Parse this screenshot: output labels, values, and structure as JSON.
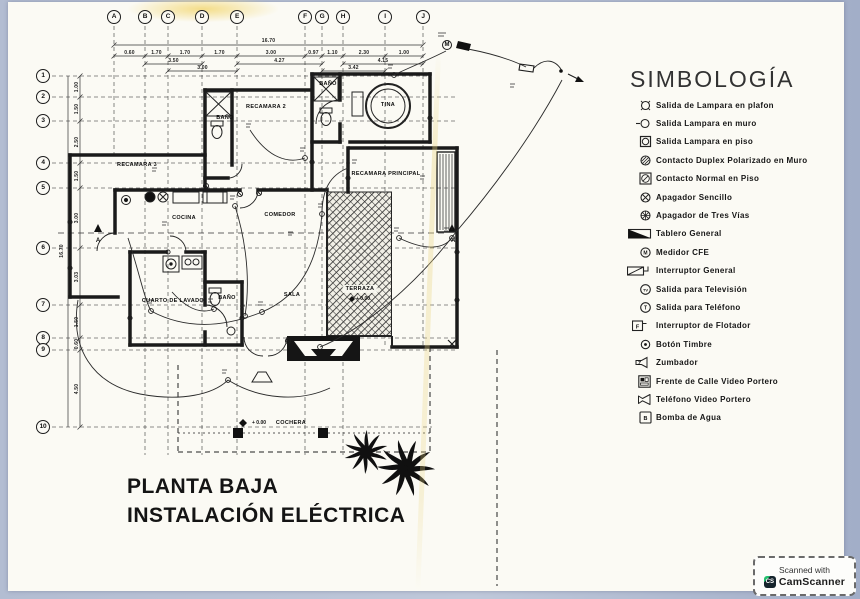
{
  "colors": {
    "paper": "#fbfaf4",
    "border_blue": "#b3bdd2",
    "ink": "#1a1a1a",
    "badge_green": "#23c06e"
  },
  "grid": {
    "columns": [
      {
        "label": "A",
        "x": 114,
        "y2": 155
      },
      {
        "label": "B",
        "x": 145,
        "y2": 455
      },
      {
        "label": "C",
        "x": 168,
        "y2": 455
      },
      {
        "label": "D",
        "x": 202,
        "y2": 455
      },
      {
        "label": "E",
        "x": 237,
        "y2": 455
      },
      {
        "label": "F",
        "x": 305,
        "y2": 455
      },
      {
        "label": "G",
        "x": 322,
        "y2": 345
      },
      {
        "label": "H",
        "x": 343,
        "y2": 455
      },
      {
        "label": "I",
        "x": 385,
        "y2": 345
      },
      {
        "label": "J",
        "x": 423,
        "y2": 347
      }
    ],
    "rows": [
      {
        "label": "1",
        "y": 76,
        "x2": 430
      },
      {
        "label": "2",
        "y": 97,
        "x2": 458
      },
      {
        "label": "3",
        "y": 121,
        "x2": 458
      },
      {
        "label": "4",
        "y": 163,
        "x2": 350
      },
      {
        "label": "5",
        "y": 188,
        "x2": 458
      },
      {
        "label": "6",
        "y": 248,
        "x2": 458
      },
      {
        "label": "7",
        "y": 305,
        "x2": 458
      },
      {
        "label": "8",
        "y": 338,
        "x2": 458
      },
      {
        "label": "9",
        "y": 350,
        "x2": 458
      },
      {
        "label": "10",
        "y": 427,
        "x2": 432
      }
    ],
    "top_total": "16.70",
    "top_segments": [
      "0.60",
      "1.70",
      "1.70",
      "1.70",
      "3.00",
      "0.97",
      "1.10",
      "2.30",
      "1.00"
    ],
    "top_partials": [
      {
        "label": "3.50",
        "x1": 145,
        "x2": 202,
        "y": 64
      },
      {
        "label": "4.27",
        "x1": 237,
        "x2": 322,
        "y": 64
      },
      {
        "label": "4.15",
        "x1": 343,
        "x2": 423,
        "y": 64
      },
      {
        "label": "3.00",
        "x1": 168,
        "x2": 237,
        "y": 71
      },
      {
        "label": "3.42",
        "x1": 322,
        "x2": 385,
        "y": 71
      }
    ],
    "left_total": "16.70",
    "left_segments": [
      "1.00",
      "1.50",
      "2.50",
      "1.50",
      "3.00",
      "3.03",
      "1.50",
      "0.60",
      "4.50"
    ]
  },
  "plan": {
    "rooms": [
      {
        "label": "RECAMARA 3",
        "x": 137,
        "y": 165
      },
      {
        "label": "RECAMARA 2",
        "x": 266,
        "y": 107
      },
      {
        "label": "BAÑO",
        "x": 225,
        "y": 118
      },
      {
        "label": "BAÑO",
        "x": 328,
        "y": 84
      },
      {
        "label": "TINA",
        "x": 388,
        "y": 105
      },
      {
        "label": "RECAMARA PRINCIPAL",
        "x": 386,
        "y": 174
      },
      {
        "label": "COCINA",
        "x": 184,
        "y": 218
      },
      {
        "label": "COMEDOR",
        "x": 280,
        "y": 215
      },
      {
        "label": "CUARTO DE LAVADO",
        "x": 173,
        "y": 301
      },
      {
        "label": "BAÑO",
        "x": 227,
        "y": 298
      },
      {
        "label": "SALA",
        "x": 292,
        "y": 295
      },
      {
        "label": "TERRAZA",
        "x": 360,
        "y": 289
      },
      {
        "label": "COCHERA",
        "x": 291,
        "y": 423
      }
    ],
    "marks": [
      {
        "label": "A",
        "x": 98,
        "y": 241
      },
      {
        "label": "A'",
        "x": 454,
        "y": 241
      },
      {
        "label": "M",
        "x": 447,
        "y": 45
      },
      {
        "label": "+ 0.00",
        "x": 259,
        "y": 423
      },
      {
        "label": "+ 0.00",
        "x": 363,
        "y": 299
      }
    ]
  },
  "legend": {
    "title": "SIMBOLOGÍA",
    "items": [
      {
        "icon": "ceiling-lamp-outlet",
        "label": "Salida de Lampara en plafon"
      },
      {
        "icon": "wall-lamp-outlet",
        "label": "Salida Lampara en muro"
      },
      {
        "icon": "floor-lamp-outlet",
        "label": "Salida Lampara en piso"
      },
      {
        "icon": "duplex-contact",
        "label": "Contacto Duplex Polarizado en Muro"
      },
      {
        "icon": "floor-contact",
        "label": "Contacto Normal en Piso"
      },
      {
        "icon": "single-switch",
        "label": "Apagador Sencillo"
      },
      {
        "icon": "three-way-switch",
        "label": "Apagador de Tres Vías"
      },
      {
        "icon": "main-panel",
        "label": "Tablero General"
      },
      {
        "icon": "cfe-meter",
        "label": "Medidor CFE",
        "icon_text": "M"
      },
      {
        "icon": "main-breaker",
        "label": "Interruptor General"
      },
      {
        "icon": "tv-outlet",
        "label": "Salida para Televisión",
        "icon_text": "TV"
      },
      {
        "icon": "phone-outlet",
        "label": "Salida para Teléfono",
        "icon_text": "T"
      },
      {
        "icon": "float-switch",
        "label": "Interruptor de Flotador",
        "icon_text": "F"
      },
      {
        "icon": "doorbell-button",
        "label": "Botón Timbre"
      },
      {
        "icon": "buzzer",
        "label": "Zumbador",
        "icon_text": "Z"
      },
      {
        "icon": "video-intercom-street",
        "label": "Frente de Calle Video Portero"
      },
      {
        "icon": "video-intercom-phone",
        "label": "Teléfono Video Portero"
      },
      {
        "icon": "water-pump",
        "label": "Bomba de Agua",
        "icon_text": "B"
      }
    ]
  },
  "title_block": {
    "line1": "PLANTA BAJA",
    "line2": "INSTALACIÓN ELÉCTRICA"
  },
  "scanner_badge": {
    "line1": "Scanned with",
    "brand": "CamScanner",
    "icon_text": "CS"
  }
}
